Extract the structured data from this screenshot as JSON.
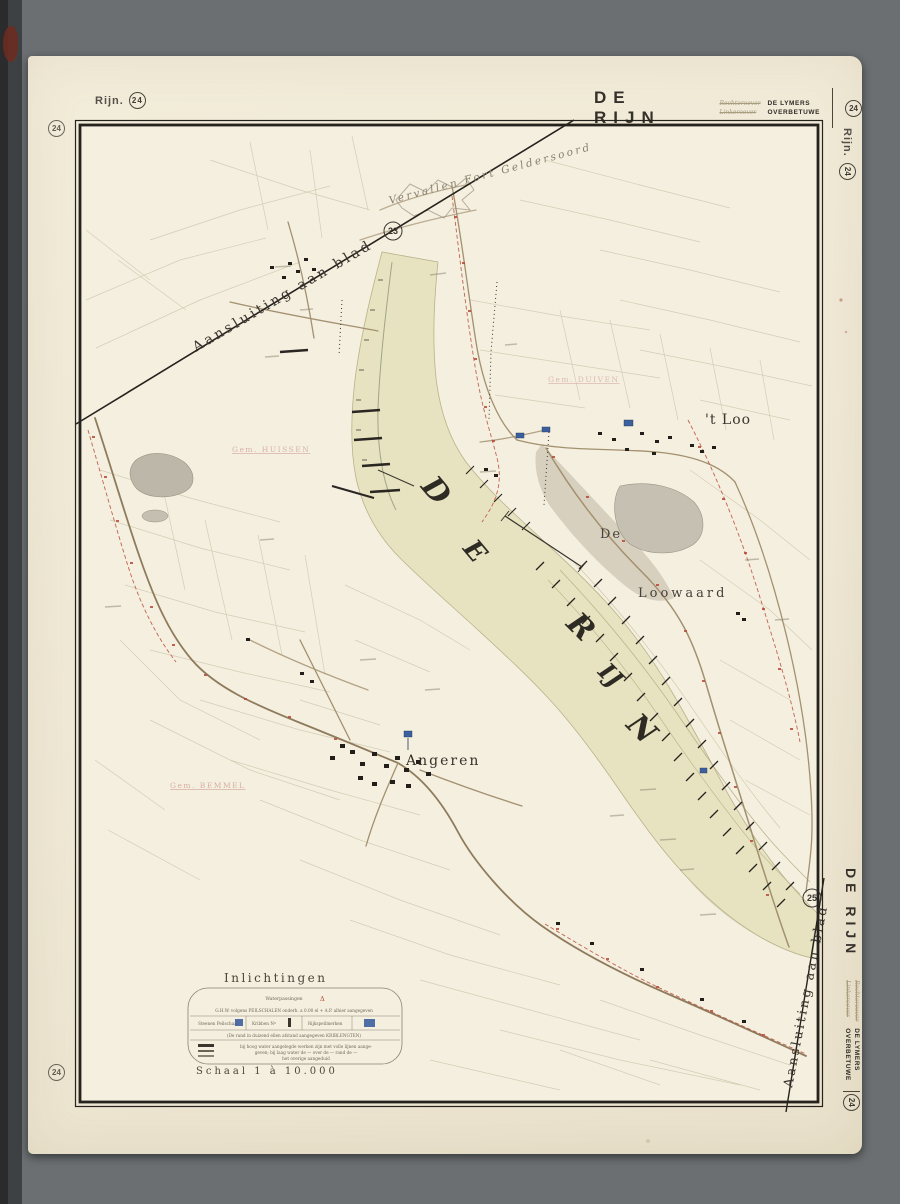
{
  "sheet": {
    "series": "Rijn.",
    "number": "24",
    "title": "DE RIJN",
    "bank_top": "Rechteroever",
    "bank_bottom": "Linkeroever",
    "region_top": "DE LYMERS",
    "region_bottom": "OVERBETUWE"
  },
  "map": {
    "join_label": "Aansluiting aan blad",
    "join_sheet_top": "23",
    "join_sheet_bottom": "25",
    "river_letters": [
      "D",
      "E",
      "R",
      "IJ",
      "N"
    ],
    "places": {
      "fort": "Vervallen Fort Geldersoord",
      "t_loo": "'t Loo",
      "de": "De",
      "loowaard": "Loowaard",
      "angeren": "Angeren",
      "gem_huissen": "Gem. HUISSEN",
      "gem_bemmel": "Gem. BEMMEL",
      "gem_duiven": "Gem. DUIVEN"
    }
  },
  "legend": {
    "title": "Inlichtingen",
    "row1_label": "Waterpassingen",
    "row1_symbol": "Δ",
    "row2": "G.H.W. volgens PEILSCHALEN onderh. a 0.00 el + A.P. alhier aangegeven",
    "row3": [
      {
        "label": "Steenen Peilschaal"
      },
      {
        "label": "Kribben Nº"
      },
      {
        "label": "Rijkspeilmerken"
      }
    ],
    "row3_note": "(De rand in duizend ellen afstand aangegeven KRIBLENGTEN)",
    "row4_line1": "bij hoog water aangelegde werken zijn met volle lijnen aange-",
    "row4_line2": "geven;  bij laag water de — over de — rand de —",
    "row4_line3": "het overige aangeduid",
    "scale": "Schaal 1 à 10.000"
  },
  "colors": {
    "desk_grey": "#6b6f71",
    "paper": "#f1ebd9",
    "map_paper": "#f4efdf",
    "river_fill": "#e7e3c0",
    "ink": "#2f2b25",
    "road_sepia": "#a3906f",
    "boundary_red": "#b84a38",
    "water_blue": "#3c5f9e",
    "municipality_pink": "#d2a49a"
  }
}
